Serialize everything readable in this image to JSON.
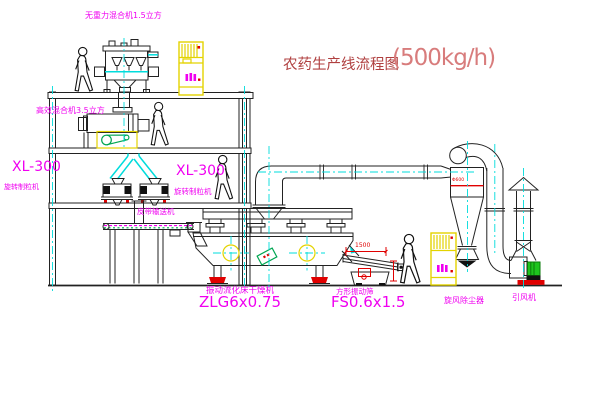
{
  "title": {
    "name_zh": "农药生产线流程图",
    "capacity": "(500kg/h)"
  },
  "equipment_labels": {
    "gravity_free_mixer": "无重力混合机1.5立方",
    "high_efficiency_mixer": "高效混合机3.5立方",
    "granulator_left_model": "XL-300",
    "granulator_left_name": "旋转制粒机",
    "granulator_right_model": "XL-300",
    "granulator_right_name": "旋转制粒机",
    "belt_conveyor": "皮带输送机",
    "fluid_bed_dryer_name": "振动流化床干燥机",
    "fluid_bed_dryer_model": "ZLG6x0.75",
    "vibrating_screen_name": "方形振动筛",
    "vibrating_screen_model": "FS0.6x1.5",
    "cyclone_collector": "旋风除尘器",
    "induced_draft_fan": "引风机"
  },
  "dimensions": {
    "screen_length": "1500",
    "cyclone_note": "Φ600"
  },
  "colors": {
    "label_magenta": "#f000f0",
    "title_red": "#b04040",
    "capacity_red": "#d87c7c",
    "centerline_cyan": "#00dcdc",
    "cabinet_yellow": "#e3d300",
    "accent_red": "#e00000",
    "accent_green": "#00a651",
    "line_black": "#222222"
  }
}
